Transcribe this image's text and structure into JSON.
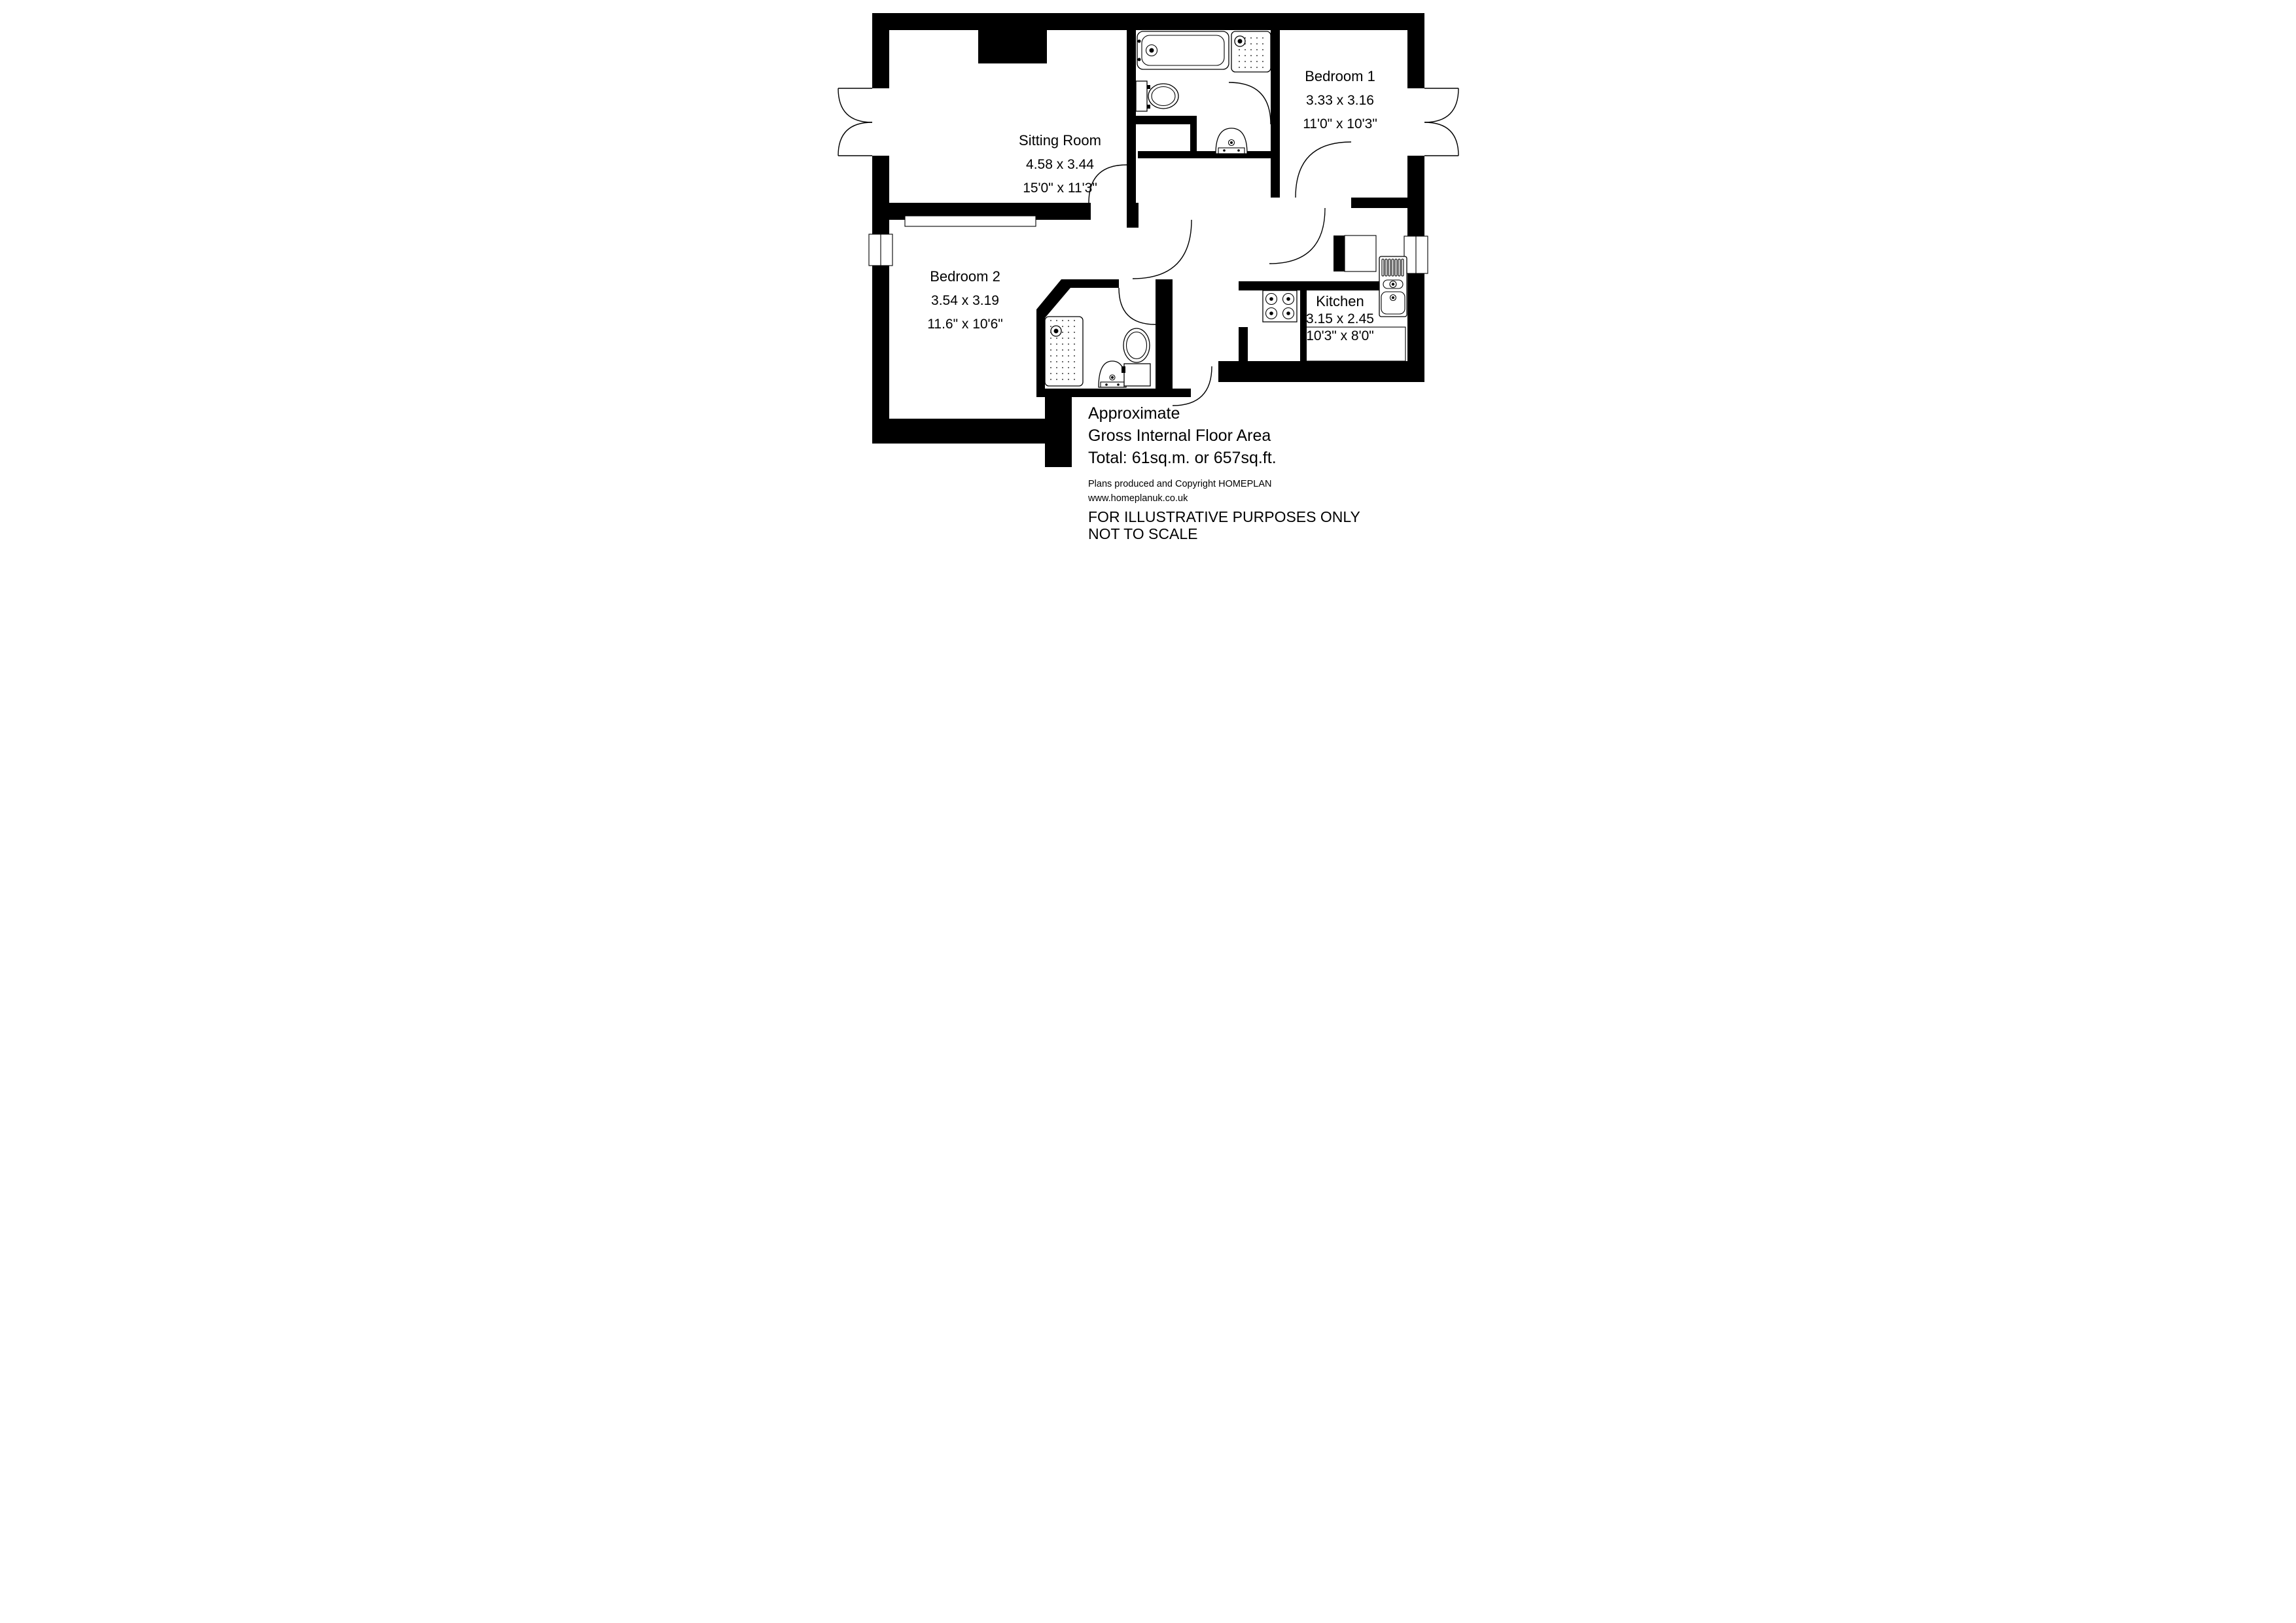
{
  "rooms": [
    {
      "name": "Sitting Room",
      "metric": "4.58 x 3.44",
      "imperial": "15'0\" x 11'3\""
    },
    {
      "name": "Bedroom 1",
      "metric": "3.33 x 3.16",
      "imperial": "11'0\" x 10'3\""
    },
    {
      "name": "Bedroom 2",
      "metric": "3.54 x 3.19",
      "imperial": "11.6\" x 10'6\""
    },
    {
      "name": "Kitchen",
      "metric": "3.15 x 2.45",
      "imperial": "10'3\" x 8'0\""
    }
  ],
  "footer": {
    "area_line1": "Approximate",
    "area_line2": "Gross Internal Floor Area",
    "area_line3": "Total: 61sq.m. or 657sq.ft.",
    "copyright_line1": "Plans produced and Copyright HOMEPLAN",
    "copyright_line2": "www.homeplanuk.co.uk",
    "disclaimer_line1": "FOR ILLUSTRATIVE PURPOSES ONLY",
    "disclaimer_line2": "NOT TO SCALE"
  },
  "fixtures": [
    "bath",
    "shower-tray",
    "toilet",
    "wash-basin",
    "hob",
    "sink-unit",
    "kitchen-counter",
    "wardrobe-recess",
    "cupboard",
    "window",
    "french-doors",
    "entrance-door"
  ],
  "colors": {
    "wall": "#000000",
    "background": "#ffffff"
  }
}
